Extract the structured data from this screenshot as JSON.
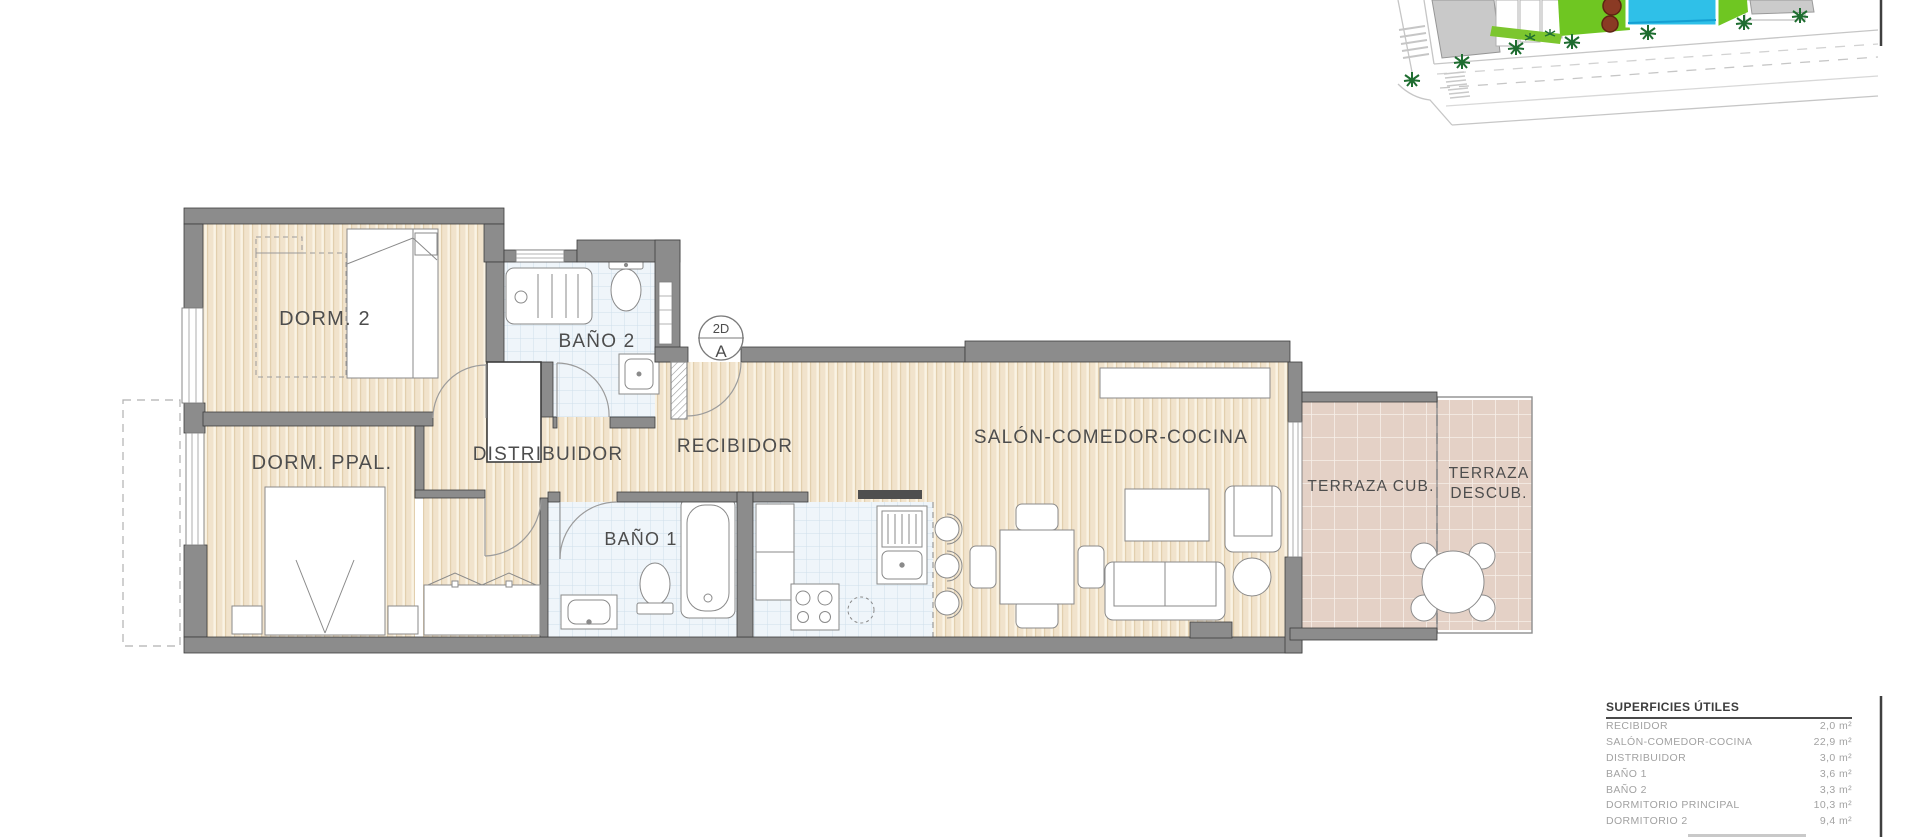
{
  "plan": {
    "rooms": {
      "dorm2": "DORM. 2",
      "banyo2": "BAÑO 2",
      "dorm_ppal": "DORM. PPAL.",
      "distribuidor": "DISTRIBUIDOR",
      "recibidor": "RECIBIDOR",
      "banyo1": "BAÑO 1",
      "salon": "SALÓN-COMEDOR-COCINA",
      "terraza_cub": "TERRAZA CUB.",
      "terraza_descub_line1": "TERRAZA",
      "terraza_descub_line2": "DESCUB."
    },
    "section_marker": {
      "top": "2D",
      "bottom": "A"
    }
  },
  "areas_table": {
    "title": "SUPERFICIES ÚTILES",
    "rows": [
      {
        "label": "RECIBIDOR",
        "value": "2,0 m²"
      },
      {
        "label": "SALÓN-COMEDOR-COCINA",
        "value": "22,9 m²"
      },
      {
        "label": "DISTRIBUIDOR",
        "value": "3,0 m²"
      },
      {
        "label": "BAÑO 1",
        "value": "3,6 m²"
      },
      {
        "label": "BAÑO 2",
        "value": "3,3 m²"
      },
      {
        "label": "DORMITORIO PRINCIPAL",
        "value": "10,3 m²"
      },
      {
        "label": "DORMITORIO 2",
        "value": "9,4 m²"
      }
    ]
  },
  "colors": {
    "wall": "#8c8c8c",
    "wall_outline": "#3d3d3d",
    "wood_floor": "#f1e3cc",
    "bath_tile": "#eff5fa",
    "terrace_tile": "#e4d1c6",
    "label_text": "#4d4d4d",
    "pool": "#2fc0e8",
    "lawn": "#6fc622",
    "palm": "#1e6d30"
  }
}
